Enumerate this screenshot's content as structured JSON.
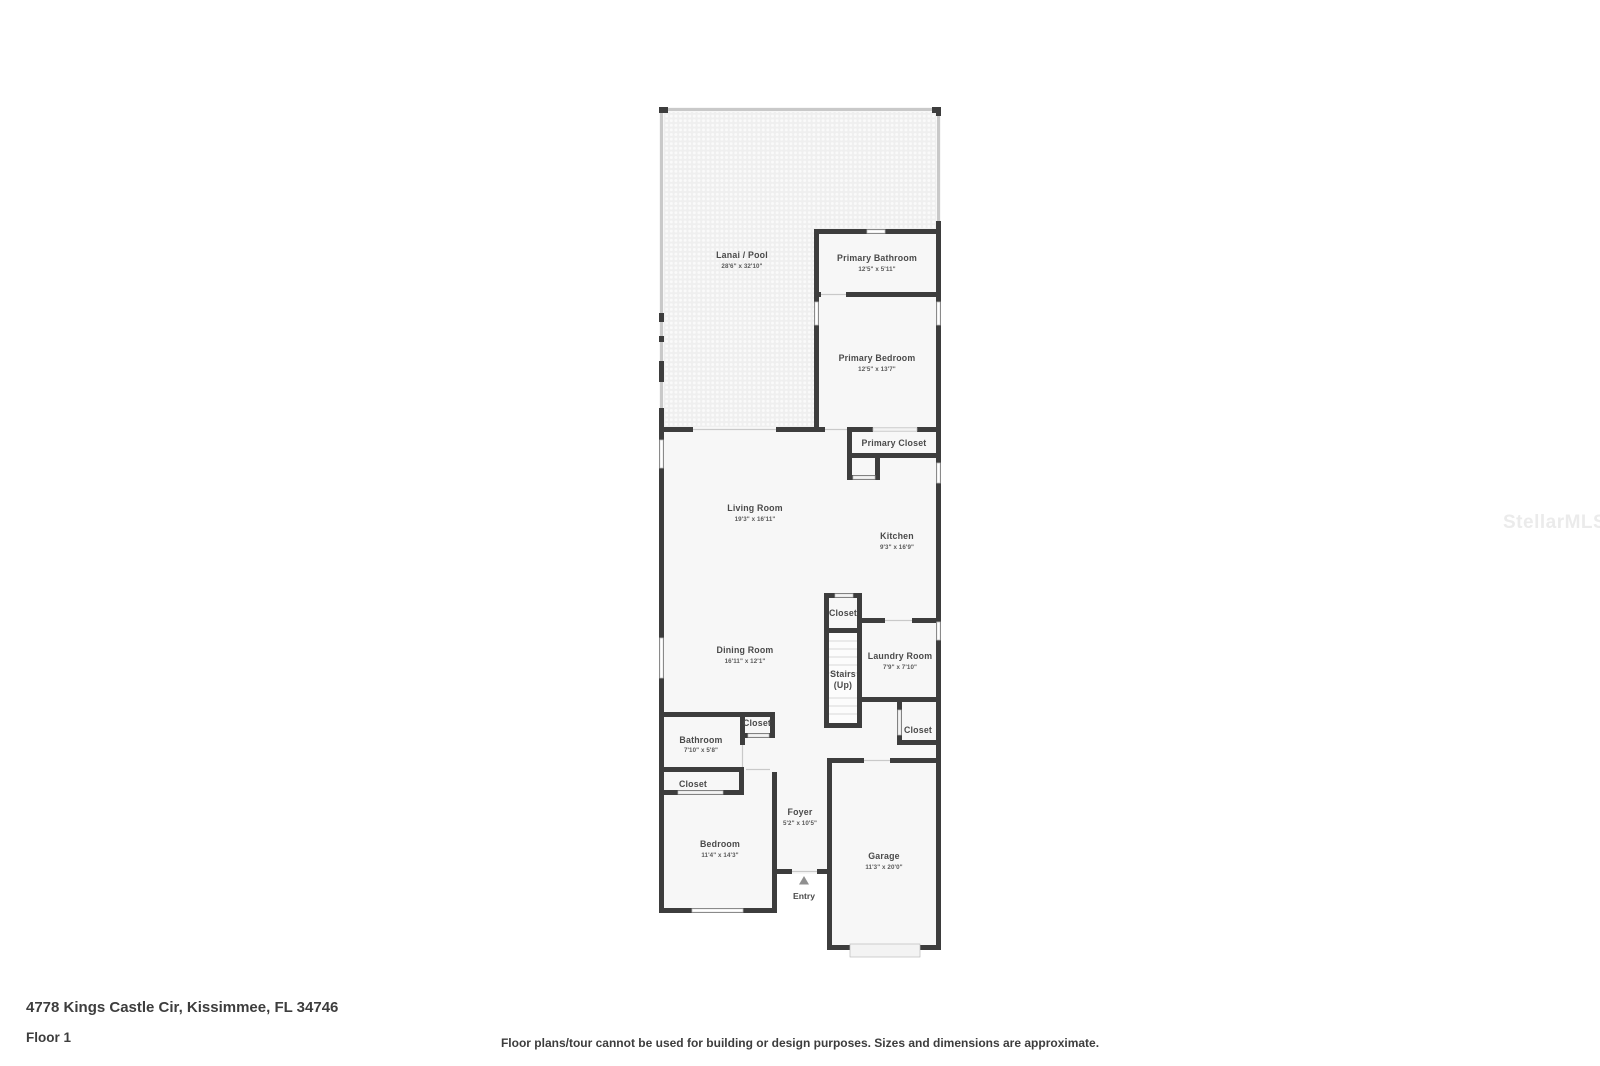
{
  "floorplan": {
    "rooms": {
      "lanai": {
        "name": "Lanai / Pool",
        "dims": "28'6\" x 32'10\""
      },
      "primary_bathroom": {
        "name": "Primary Bathroom",
        "dims": "12'5\" x 5'11\""
      },
      "primary_bedroom": {
        "name": "Primary Bedroom",
        "dims": "12'5\" x 13'7\""
      },
      "primary_closet": {
        "name": "Primary Closet"
      },
      "living_room": {
        "name": "Living Room",
        "dims": "19'3\" x 16'11\""
      },
      "kitchen": {
        "name": "Kitchen",
        "dims": "9'3\" x 16'9\""
      },
      "closet_stairs": {
        "name": "Closet"
      },
      "stairs": {
        "name": "Stairs",
        "dims": "(Up)"
      },
      "laundry_room": {
        "name": "Laundry Room",
        "dims": "7'9\" x 7'10\""
      },
      "dining_room": {
        "name": "Dining Room",
        "dims": "16'11\" x 12'1\""
      },
      "closet_garage": {
        "name": "Closet"
      },
      "bathroom": {
        "name": "Bathroom",
        "dims": "7'10\" x 5'8\""
      },
      "closet_bathroom": {
        "name": "Closet"
      },
      "closet_bedroom": {
        "name": "Closet"
      },
      "bedroom": {
        "name": "Bedroom",
        "dims": "11'4\" x 14'3\""
      },
      "foyer": {
        "name": "Foyer",
        "dims": "5'2\" x 10'5\""
      },
      "garage": {
        "name": "Garage",
        "dims": "11'3\" x 20'0\""
      }
    },
    "entry_label": "Entry"
  },
  "footer": {
    "address": "4778 Kings Castle Cir, Kissimmee, FL 34746",
    "floor_label": "Floor 1",
    "disclaimer": "Floor plans/tour cannot be used for building or design purposes. Sizes and dimensions are approximate."
  },
  "watermark": "StellarMLS",
  "colors": {
    "wall": "#3d3d3d",
    "room_fill": "#f7f7f7",
    "lanai_base": "#efefef",
    "window_stroke": "#bdbdbd",
    "label_text": "#4a4a4a"
  }
}
